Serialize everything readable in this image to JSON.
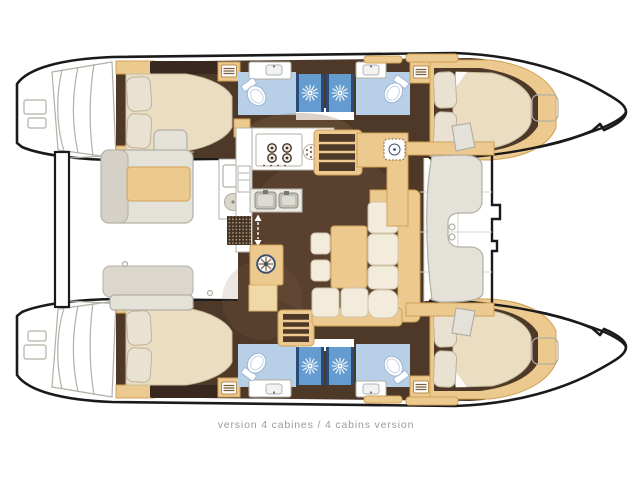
{
  "caption": {
    "text": "version 4 cabines / 4 cabins version"
  },
  "layout_summary": {
    "cabins": 4,
    "double_beds": 4,
    "bathrooms": 4,
    "shower_stalls": 4
  },
  "palette": {
    "background": "#ffffff",
    "hull_outline": "#1a1a1a",
    "floor_brown": "#4e3828",
    "wood_tan": "#ecca8f",
    "wood_tan_border": "#cfa055",
    "mattress_cream": "#eaddc2",
    "cushion_cream": "#f3ecdc",
    "bath_floor_blue": "#b7cfe7",
    "shower_blue": "#649ccf",
    "shower_navy": "#2a4a78",
    "deck_gray_fill": "#e4e1d9",
    "deck_gray_line": "#b2afa5",
    "caption_gray": "#9b9b9b"
  },
  "icons": {
    "shower_sun": "sunburst shower-drain symbol",
    "towel_rack": "slatted locker symbol in bathroom cabinet",
    "stove_burners": "four-burner hob",
    "round_hob": "round single hob beside stove",
    "double_sink": "twin galley sink",
    "helm_wheel": "spoked wheel symbol on saloon cabinet",
    "nav_dial": "instrument dial at nav seat",
    "entry_arrows": "double-headed dashed arrow at companionway",
    "deck_hatch": "rounded-square bow deck hatch"
  }
}
